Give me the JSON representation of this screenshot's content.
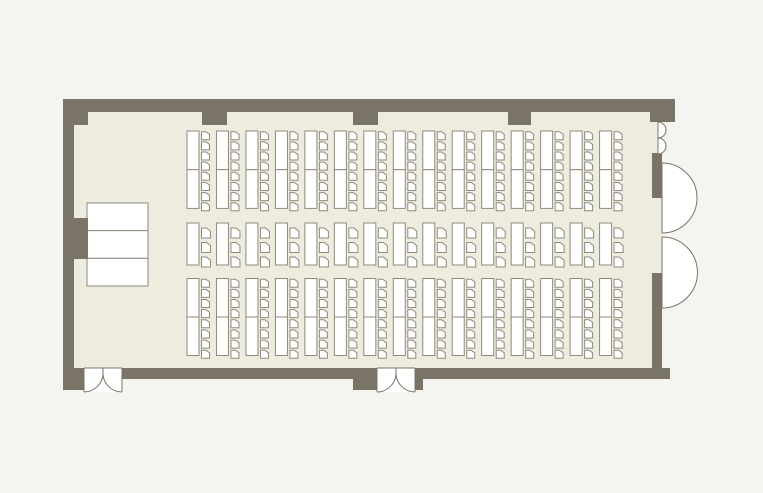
{
  "page": {
    "title": "seminar-room-floor-plan"
  },
  "floor_plan": {
    "canvas": {
      "width": 763,
      "height": 493,
      "background": "#f4f4f1"
    },
    "colors": {
      "floor": "#edecdf",
      "wall": "#7a7466",
      "furniture_stroke": "#8f8a7c",
      "furniture_fill": "#ffffff",
      "door_stroke": "#7a7466",
      "door_fill": "#ffffff"
    },
    "floor": {
      "x": 63,
      "y": 99,
      "w": 599,
      "h": 280
    },
    "walls": [
      {
        "name": "top-wall",
        "x": 63,
        "y": 99,
        "w": 612,
        "h": 13
      },
      {
        "name": "top-left-corner-pillar",
        "x": 63,
        "y": 99,
        "w": 25,
        "h": 26
      },
      {
        "name": "top-pillar-1",
        "x": 202,
        "y": 99,
        "w": 25,
        "h": 26
      },
      {
        "name": "top-pillar-2",
        "x": 353,
        "y": 99,
        "w": 25,
        "h": 26
      },
      {
        "name": "top-pillar-3",
        "x": 508,
        "y": 99,
        "w": 23,
        "h": 26
      },
      {
        "name": "top-right-corner-pillar",
        "x": 650,
        "y": 99,
        "w": 25,
        "h": 23
      },
      {
        "name": "left-wall",
        "x": 63,
        "y": 99,
        "w": 11,
        "h": 280
      },
      {
        "name": "left-wall-pillar",
        "x": 63,
        "y": 218,
        "w": 25,
        "h": 41
      },
      {
        "name": "bottom-wall",
        "x": 63,
        "y": 368,
        "w": 607,
        "h": 11
      },
      {
        "name": "bottom-left-corner-pillar",
        "x": 63,
        "y": 368,
        "w": 21,
        "h": 22
      },
      {
        "name": "bottom-door-jamb-left",
        "x": 353,
        "y": 368,
        "w": 24,
        "h": 22
      },
      {
        "name": "bottom-door-jamb-right",
        "x": 415,
        "y": 368,
        "w": 8,
        "h": 22
      },
      {
        "name": "right-wall-upper",
        "x": 652,
        "y": 153,
        "w": 10,
        "h": 45
      },
      {
        "name": "right-wall-lower",
        "x": 652,
        "y": 273,
        "w": 10,
        "h": 95
      }
    ],
    "stage": {
      "x": 87,
      "y": 203,
      "w": 61,
      "h": 83,
      "sections": 3
    },
    "seating": {
      "columns": 15,
      "first_x": 187,
      "pitch": 29.47,
      "table_w": 12,
      "chair_offset_x": 14.5,
      "bands": [
        {
          "name": "front-band",
          "type": "double",
          "y": 131,
          "table_h": 38.7,
          "chairs": 8,
          "chair_y0": 131.7,
          "chair_pitch": 10.15,
          "chair_w": 8,
          "chair_h": 8
        },
        {
          "name": "middle-band",
          "type": "single",
          "y": 223,
          "table_h": 42,
          "chairs": 3,
          "chair_y0": 228,
          "chair_pitch": 14.5,
          "chair_w": 9,
          "chair_h": 10
        },
        {
          "name": "back-band",
          "type": "double",
          "y": 278.5,
          "table_h": 38.5,
          "chairs": 8,
          "chair_y0": 279.2,
          "chair_pitch": 10.15,
          "chair_w": 8,
          "chair_h": 8
        }
      ]
    },
    "doors": {
      "bottom_double_doors": [
        {
          "name": "bottom-left-double-door",
          "x0": 84,
          "x1": 122,
          "y": 368,
          "depth": 24
        },
        {
          "name": "bottom-middle-double-door",
          "x0": 377,
          "x1": 415,
          "y": 368,
          "depth": 24
        }
      ],
      "right_swing_doors": [
        {
          "name": "right-swing-door-upper",
          "cx": 662,
          "cy": 198,
          "r": 35
        },
        {
          "name": "right-swing-door-lower",
          "cx": 662,
          "cy": 272.5,
          "r": 35.5
        }
      ],
      "right_small_arcs": [
        {
          "name": "right-small-door-arc-1",
          "x": 658,
          "y0": 122,
          "y1": 138,
          "r": 8
        },
        {
          "name": "right-small-door-arc-2",
          "x": 658,
          "y0": 138,
          "y1": 154,
          "r": 8
        }
      ]
    }
  }
}
